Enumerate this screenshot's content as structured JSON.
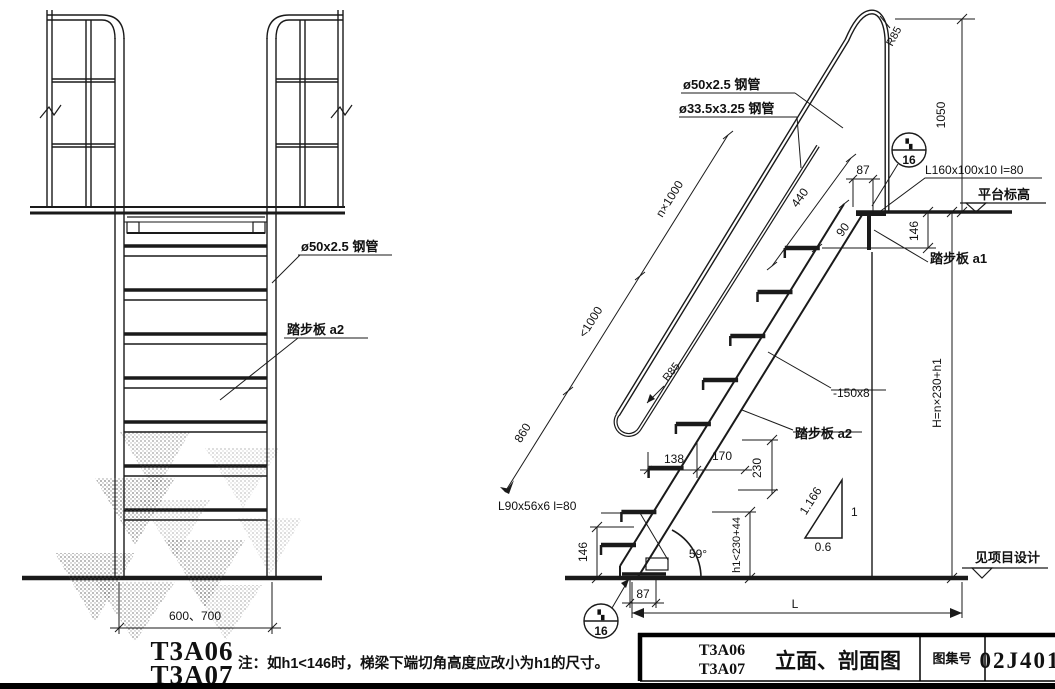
{
  "left_view": {
    "label_pipe": "ø50x2.5 钢管",
    "label_tread": "踏步板 a2",
    "dim_width": "600、700",
    "model_1": "T3A06",
    "model_2": "T3A07"
  },
  "right_view": {
    "label_pipe_50": "ø50x2.5 钢管",
    "label_pipe_33": "ø33.5x3.25 钢管",
    "label_radius_top": "R85",
    "label_radius_mid": "R85",
    "label_angle_top": "L160x100x10  l=80",
    "label_angle_bottom": "L90x56x6  l=80",
    "label_flat_bar": "-150x8",
    "label_tread_a1": "踏步板 a1",
    "label_tread_a2": "踏步板 a2",
    "label_platform_level": "平台标高",
    "label_design_level": "见项目设计",
    "dim_1050": "1050",
    "dim_87_top": "87",
    "dim_146_top": "146",
    "dim_440": "440",
    "dim_90": "90",
    "dim_n1000": "n×1000",
    "dim_lt1000": "<1000",
    "dim_860": "860",
    "dim_138": "138",
    "dim_170": "170",
    "dim_230": "230",
    "dim_h1": "h1<230+44",
    "dim_angle": "59°",
    "dim_146_bottom": "146",
    "dim_87_bottom": "87",
    "dim_L": "L",
    "dim_H": "H=n×230+h1",
    "slope_hyp": "1.166",
    "slope_rise": "1",
    "slope_run": "0.6",
    "detail_top_glyph": "▚",
    "detail_page": "16"
  },
  "note": "注：如h1<146时，梯梁下端切角高度应改小为h1的尺寸。",
  "title_block": {
    "model_1": "T3A06",
    "model_2": "T3A07",
    "sheet_title": "立面、剖面图",
    "atlas_label": "图集号",
    "atlas_number": "02J401"
  }
}
